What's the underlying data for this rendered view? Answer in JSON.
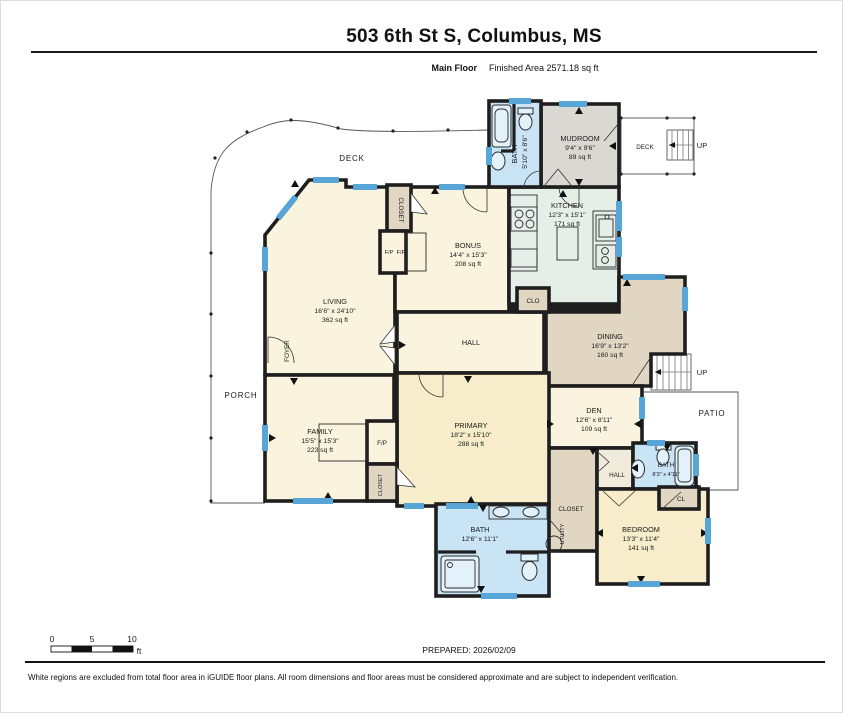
{
  "header": {
    "title": "503 6th St S, Columbus, MS",
    "floor_label": "Main Floor",
    "area_label": "Finished Area 2571.18 sq ft"
  },
  "rooms": {
    "living": {
      "name": "LIVING",
      "dims": "16'6\" x 24'10\"",
      "area": "362 sq ft"
    },
    "bonus": {
      "name": "BONUS",
      "dims": "14'4\" x 15'3\"",
      "area": "208 sq ft"
    },
    "kitchen": {
      "name": "KITCHEN",
      "dims": "12'3\" x 15'1\"",
      "area": "171 sq ft"
    },
    "mudroom": {
      "name": "MUDROOM",
      "dims": "9'4\" x 9'6\"",
      "area": "89 sq ft"
    },
    "bath_top": {
      "name": "BATH",
      "dims": "5'10\" x 8'6\""
    },
    "dining": {
      "name": "DINING",
      "dims": "16'9\" x 13'2\"",
      "area": "160 sq ft"
    },
    "den": {
      "name": "DEN",
      "dims": "12'6\" x 8'11\"",
      "area": "109 sq ft"
    },
    "family": {
      "name": "FAMILY",
      "dims": "15'5\" x 15'3\"",
      "area": "223 sq ft"
    },
    "primary": {
      "name": "PRIMARY",
      "dims": "18'2\" x 15'10\"",
      "area": "288 sq ft"
    },
    "bedroom": {
      "name": "BEDROOM",
      "dims": "13'3\" x 11'4\"",
      "area": "141 sq ft"
    },
    "bath_main": {
      "name": "BATH",
      "dims": "12'6\" x 11'1\""
    },
    "bath_small": {
      "name": "BATH",
      "dims": "8'3\" x 4'11\""
    },
    "hall": "HALL",
    "hall_small": "HALL",
    "foyer": "FOYER",
    "closet_living": "CLOSET",
    "closet_family": "CLOSET",
    "closet_utility": "CLOSET",
    "utility": "UTILITY",
    "clo": "CLO",
    "cl": "CL"
  },
  "fireplaces": {
    "living": "F/P",
    "bonus": "F/P",
    "family": "F/P"
  },
  "outdoor": {
    "deck_large": "DECK",
    "deck_small": "DECK",
    "porch": "PORCH",
    "patio": "PATIO",
    "up_deck": "UP",
    "up_stairs": "UP"
  },
  "scale_bar": {
    "tick_0": "0",
    "tick_5": "5",
    "tick_10": "10",
    "unit": "ft"
  },
  "footer": {
    "prepared": "PREPARED: 2026/02/09",
    "disclaimer": "White regions are excluded from total floor area in iGUIDE floor plans. All room dimensions and floor areas must be considered approximate and are subject to independent verification."
  },
  "colors": {
    "wall": "#1e1e1e",
    "window": "#58a6d8",
    "room_cream": "#faf3dd",
    "room_cream_dark": "#f8edca",
    "kitchen_mint": "#e5efe7",
    "tan": "#e0d6c2",
    "mudroom_gray": "#dad8d2",
    "bath_blue": "#c9e4f5"
  }
}
